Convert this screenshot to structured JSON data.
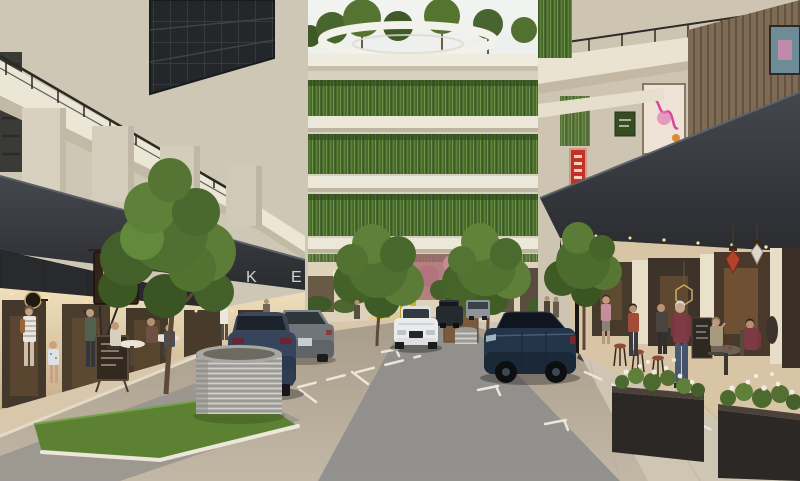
{
  "meta": {
    "type": "architectural-rendering",
    "description": "Eye-level visualization of a retail laneway between mid-rise buildings with planted balconies, a rooftop garden ring, parked cars, street trees and outdoor cafes"
  },
  "watermark": {
    "letters": [
      "K",
      "E",
      "N",
      "N",
      "Y",
      "Y",
      "L"
    ]
  },
  "palette": {
    "sky": "#eef1ef",
    "facade_cream": "#d8d1c0",
    "facade_shadow": "#c9bfa9",
    "glass_dark": "#23272a",
    "canopy_steel": "#383b40",
    "plant_green": "#55762f",
    "tree_green": "#4f7030",
    "grass": "#5c8133",
    "road_tan": "#b1a593",
    "road_grey": "#8e8e8c",
    "sidewalk": "#d8c7ab",
    "marking_white": "#eae6dc",
    "car_navy": "#243449",
    "car_slate": "#36455c",
    "car_grey": "#70757a",
    "car_white": "#e9ebec",
    "sign_red": "#c23227",
    "neon_pink": "#d446a0",
    "gate_yellow": "#d9bc27",
    "lantern_red": "#b5432c",
    "downlight_warm": "#ffe2a8",
    "wood_slat": "#7d6b55"
  }
}
